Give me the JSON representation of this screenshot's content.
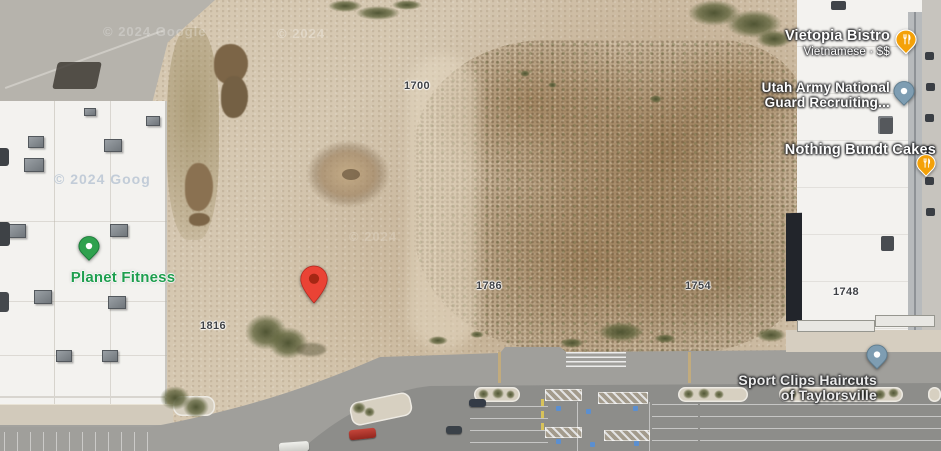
{
  "map_type": "satellite",
  "attribution": {
    "top_left": "© 2024 Google",
    "top_right": "© 2024",
    "roof": "© 2024 Goog",
    "center": "© 2024"
  },
  "places": {
    "vietopia": {
      "name": "Vietopia Bistro",
      "subtitle": "Vietnamese · $$",
      "pin": "restaurant"
    },
    "utah_guard": {
      "line1": "Utah Army National",
      "line2": "Guard Recruiting...",
      "pin": "generic"
    },
    "bundt": {
      "name": "Nothing Bundt Cakes",
      "pin": "restaurant"
    },
    "planet": {
      "name": "Planet Fitness",
      "pin": "dot"
    },
    "sport_clips": {
      "line1": "Sport Clips Haircuts",
      "line2": "of Taylorsville",
      "pin": "generic"
    }
  },
  "parcels": {
    "p1700": "1700",
    "p1786": "1786",
    "p1754": "1754",
    "p1748": "1748",
    "p1816": "1816"
  },
  "colors": {
    "pin_restaurant": "#F4A108",
    "pin_generic": "#7E9DB2",
    "pin_generic_stroke": "#5E7C8E",
    "pin_planet": "#2FA14E",
    "planet_label": "#1E9E4E",
    "marker_red": "#EA4335",
    "marker_red_inner": "#A52714",
    "marker_red_stroke": "#B3261E"
  }
}
